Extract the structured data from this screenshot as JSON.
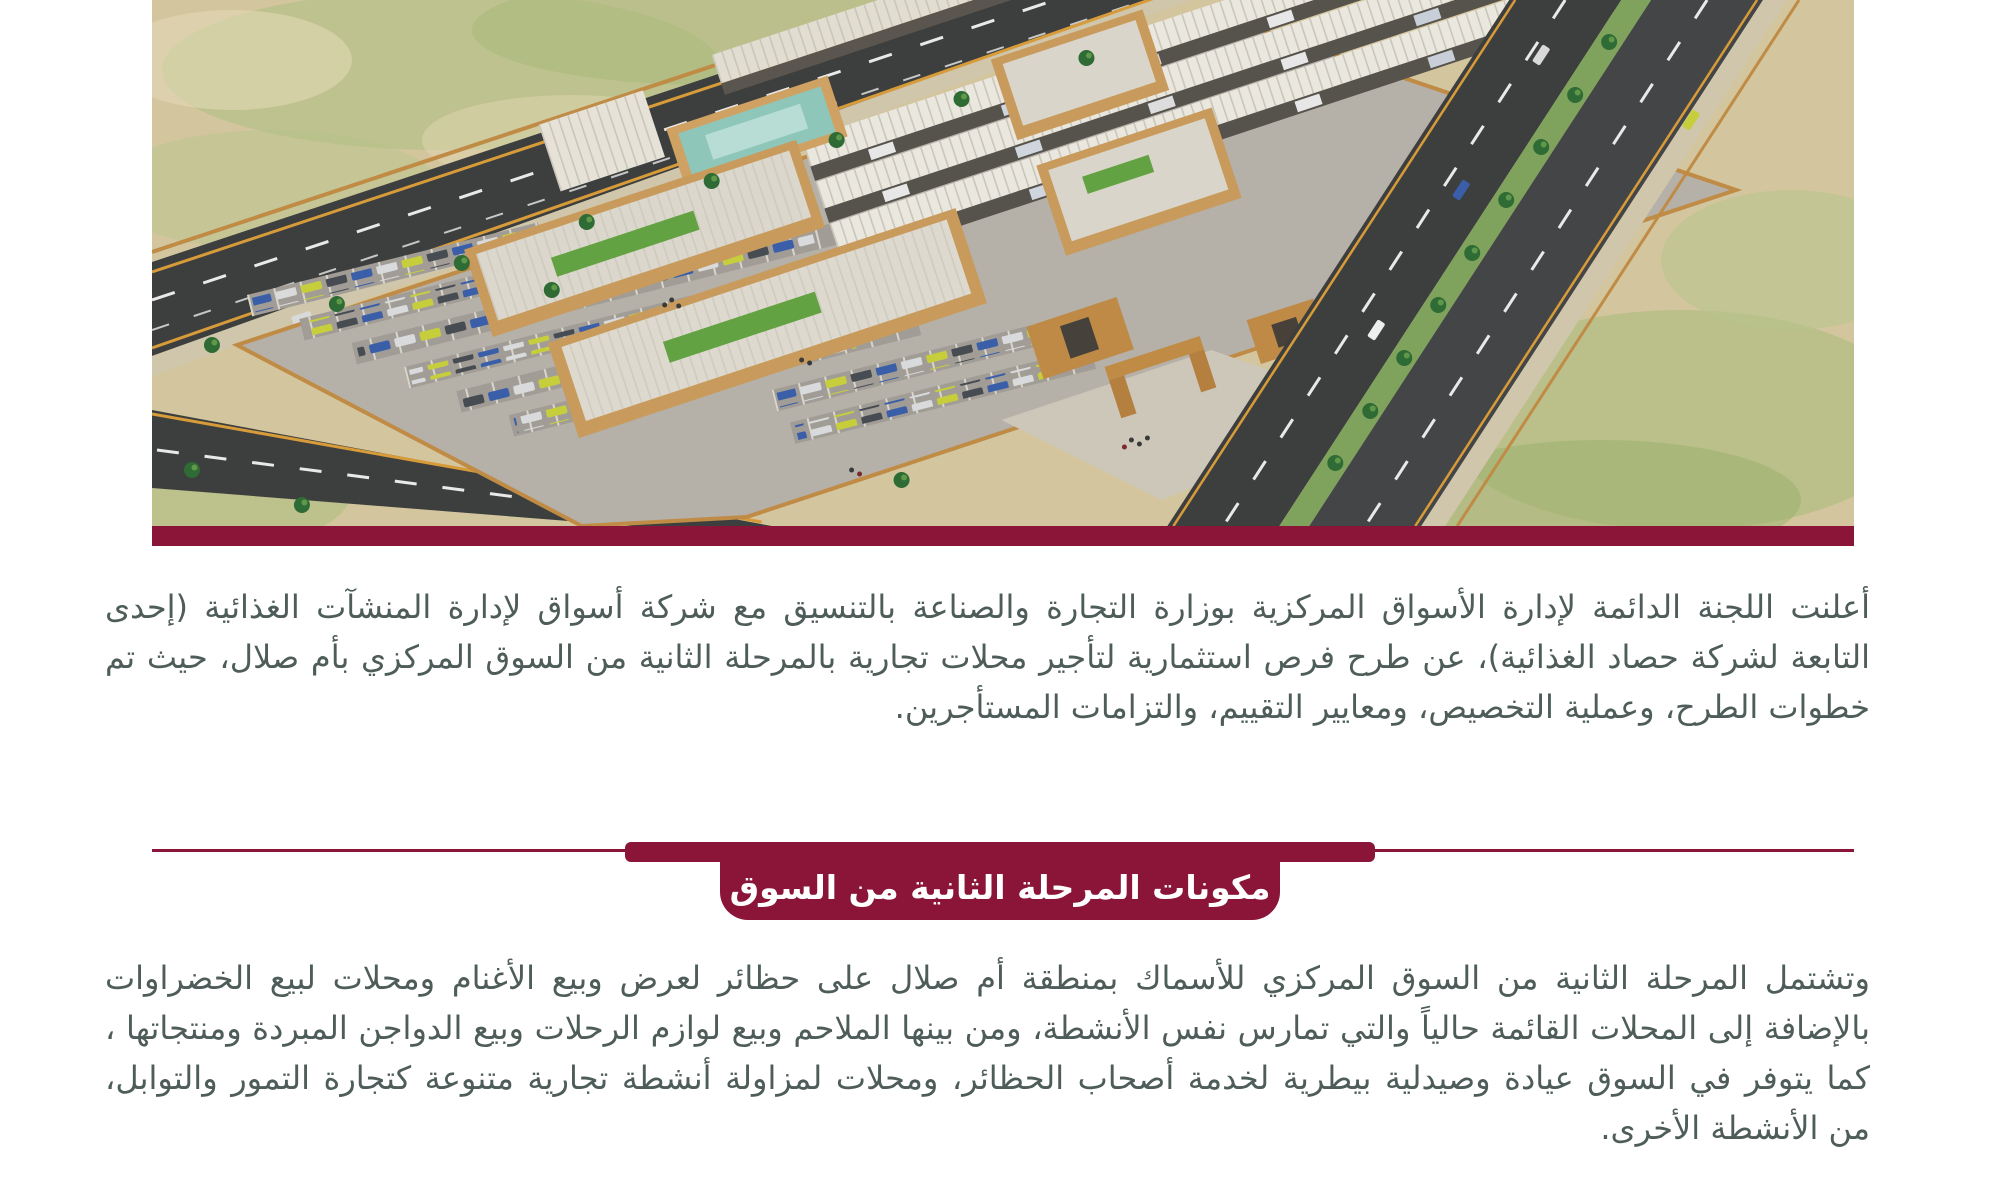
{
  "theme": {
    "accent_maroon": "#8A1538",
    "body_text": "#4E5D5A",
    "page_background": "#FFFFFF"
  },
  "hero": {
    "image_alt": "Aerial rendering of the Um Salal central market complex with parking lots, warehouses and access roads",
    "bottom_bar_color": "#8A1538"
  },
  "intro_paragraph": {
    "lines": [
      "أعلنت اللجنة الدائمة لإدارة الأسواق المركزية بوزارة التجارة والصناعة بالتنسيق مع شركة أسواق لإدارة المنشآت الغذائية (إحدى الشركات",
      "التابعة لشركة حصاد الغذائية)، عن طرح فرص استثمارية لتأجير محلات تجارية بالمرحلة الثانية من السوق المركزي بأم صلال، حيث تم تحديد",
      "خطوات الطرح، وعملية التخصيص، ومعايير التقييم، والتزامات المستأجرين."
    ]
  },
  "section_banner": {
    "title": "مكونات المرحلة الثانية من السوق"
  },
  "body_paragraph": {
    "lines": [
      "وتشتمل المرحلة الثانية من السوق المركزي للأسماك بمنطقة أم صلال على حظائر لعرض وبيع الأغنام ومحلات لبيع الخضراوات والفواكه",
      "بالإضافة إلى المحلات القائمة حالياً والتي تمارس نفس الأنشطة، ومن بينها الملاحم وبيع لوازم الرحلات وبيع الدواجن المبردة ومنتجاتها ،",
      "كما يتوفر في السوق عيادة وصيدلية بيطرية لخدمة أصحاب الحظائر، ومحلات لمزاولة أنشطة تجارية متنوعة كتجارة التمور والتوابل، وغيرها",
      "من الأنشطة الأخرى."
    ]
  }
}
